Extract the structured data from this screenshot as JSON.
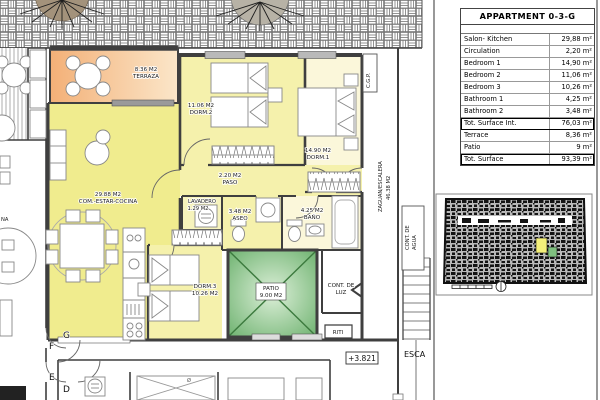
{
  "summary_table": {
    "title": "APPARTMENT 0-3-G",
    "rows": [
      {
        "label": "Salon- Kitchen",
        "value": "29,88 m²"
      },
      {
        "label": "Circulation",
        "value": "2,20 m²"
      },
      {
        "label": "Bedroom 1",
        "value": "14,90 m²"
      },
      {
        "label": "Bedroom 2",
        "value": "11,06 m²"
      },
      {
        "label": "Bedroom 3",
        "value": "10,26 m²"
      },
      {
        "label": "Bathroom 1",
        "value": "4,25 m²"
      },
      {
        "label": "Bathroom 2",
        "value": "3,48 m²"
      },
      {
        "label": "Tot. Surface Int.",
        "value": "76,03 m²"
      },
      {
        "label": "Terrace",
        "value": "8,36 m²"
      },
      {
        "label": "Patio",
        "value": "9 m²"
      },
      {
        "label": "Tot. Surface",
        "value": "93,39 m²"
      }
    ]
  },
  "rooms": {
    "terraza": {
      "line1": "8.36 M2",
      "line2": "TERRAZA"
    },
    "salon": {
      "line1": "29.88 M2",
      "line2": "COM.-ESTAR-COCINA"
    },
    "dorm2": {
      "line1": "11.06 M2",
      "line2": "DORM.2"
    },
    "dorm1": {
      "line1": "14.90 M2",
      "line2": "DORM.1"
    },
    "paso": {
      "line1": "2.20 M2",
      "line2": "PASO"
    },
    "lavadero": {
      "line1": "LAVADERO",
      "line2": "1.29 M2"
    },
    "aseo": {
      "line1": "3.48 M2",
      "line2": "ASEO"
    },
    "bano": {
      "line1": "4.25 M2",
      "line2": "BAÑO"
    },
    "dorm3": {
      "line1": "DORM.3",
      "line2": "10.26 M2"
    },
    "patio": {
      "line1": "PATIO",
      "line2": "9.00 M2"
    },
    "cont_luz": {
      "line1": "CONT. DE",
      "line2": "LUZ"
    },
    "riti": {
      "line1": "RITI"
    },
    "cont_agua": {
      "line1": "CONT. DE",
      "line2": "AGUA"
    },
    "zaguan": {
      "line1": "ZAGUAN/ESCALERA",
      "line2": "46.38 M2"
    },
    "cgp": {
      "line1": "C.G.P."
    },
    "escalera": {
      "line1": "ESCA"
    }
  },
  "annotations": {
    "level": "+3.821",
    "unit_letters": [
      "G",
      "F",
      "E",
      "D"
    ],
    "partial_label": "NA",
    "symbol_diameter": "Ø"
  },
  "colors": {
    "salon_fill": "#f0ec8e",
    "bedroom_fill": "#f5f1ac",
    "dorm1_fill": "#fbf7da",
    "terrace_from": "#f3b077",
    "terrace_to": "#fbe6c9",
    "patio_dark": "#66ae68",
    "patio_light": "#dcefd8",
    "wall": "#3f3f3f",
    "furniture": "#888888",
    "keyplan_highlight": "#f3ef7a",
    "keyplan_highlight2": "#7fbf7f"
  }
}
